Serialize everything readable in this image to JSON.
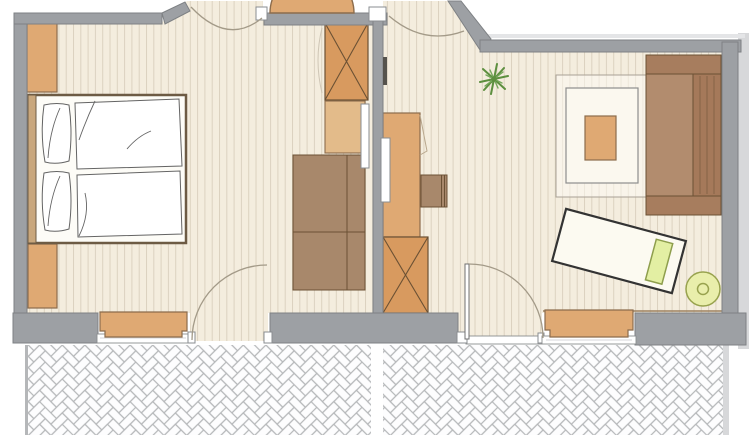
{
  "title": "apartment-floor-plan",
  "visible_text": [],
  "palette": {
    "outside": "#ffffff",
    "white": "#ffffff",
    "wall": "#9da0a4",
    "wall_stroke": "#7e8184",
    "shadow": "#d7d8da",
    "topline": "#e4e5e7",
    "frame_stroke": "#8a8d90",
    "floor": "#f4edde",
    "plank": "#dcd2c0",
    "wood_light": "#dfa973",
    "wood_mid": "#d89a5f",
    "wood_dark": "#a8886b",
    "wood_stroke": "#8c6c4c",
    "wood_dark_stroke": "#6b5134",
    "sofa_seat": "#b28c6e",
    "sofa_back": "#a5795a",
    "sofa_arm": "#a77d5e",
    "headboard": "#c9a77c",
    "bedding": "#fdfcf7",
    "bed_outline": "#6d5b44",
    "linen_stroke": "#646464",
    "arc": "#a39a88",
    "faint": "#cec5b5",
    "thresh_inner": "#c8c9cb",
    "paving_line": "#b5b7b9",
    "paving_bg": "#f7f7f8",
    "paving_brick": "#fdfdfe",
    "lime": "#e9eeab",
    "lime_stroke": "#98a24e",
    "pillow_lime": "#e3efa3",
    "pillow_lime_stroke": "#8e9e4d",
    "plant": "#5d8f3f",
    "plant2": "#76a85c",
    "dark_fitting": "#55524c",
    "rug_border": "#a9a195",
    "rug_inner": "#fbf8ef",
    "rug_inner_stroke": "#8e8e8e",
    "lounger_fill": "#fcfaf1",
    "lounger_stroke": "#333333",
    "trim": "#9b805f"
  },
  "legend": {
    "rooms": [
      "bedroom",
      "entry-hall",
      "living-room",
      "balcony"
    ],
    "bedroom_items": [
      "wall-cabinet-upper",
      "wall-cabinet-lower",
      "double-bed-with-pillows-and-duvets",
      "tall-wardrobe",
      "crossed-cabinet-at-entry",
      "side-cabinet",
      "wall-mirror"
    ],
    "living_items": [
      "desk",
      "desk-mirror",
      "desk-chair",
      "crossed-cabinet",
      "houseplant",
      "rug",
      "coffee-table",
      "sofa",
      "lounger-with-pillow",
      "round-stool",
      "window-bench"
    ],
    "openings": [
      "entry-door",
      "bedroom-door",
      "living-room-door",
      "bedroom-balcony-door",
      "living-balcony-door",
      "bedroom-window",
      "living-window"
    ],
    "balcony_items": [
      "herringbone-paving",
      "balcony-divider"
    ]
  }
}
